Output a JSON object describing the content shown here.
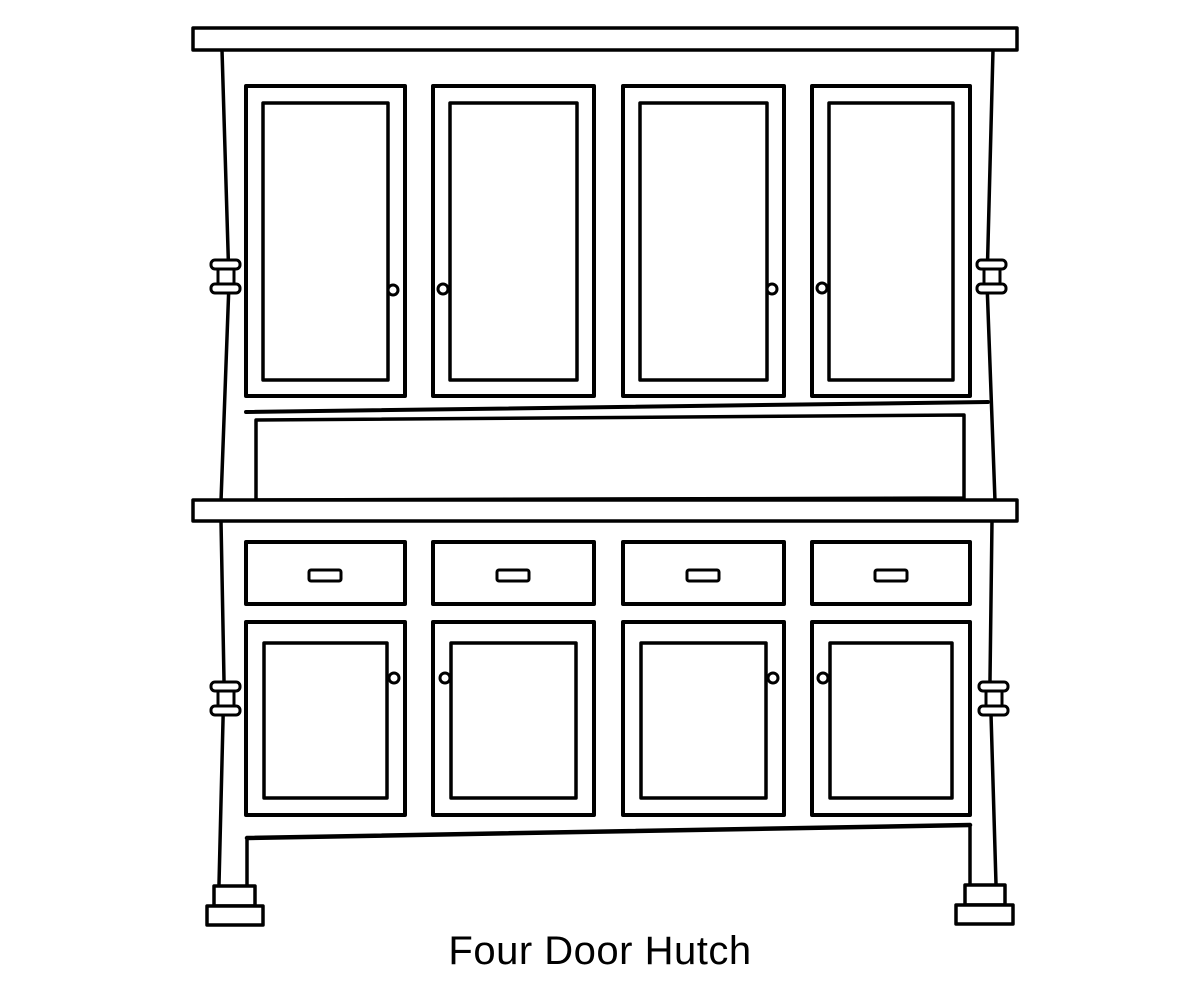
{
  "caption": {
    "text": "Four Door Hutch"
  },
  "colors": {
    "line": "#000000",
    "background": "#ffffff",
    "fill": "#ffffff"
  },
  "figure": {
    "type": "line-drawing",
    "subject": "Four Door Hutch",
    "parts": {
      "upper_doors": 4,
      "upper_door_knobs": 4,
      "open_shelf_bays": 1,
      "drawers": 4,
      "drawer_pulls": 4,
      "lower_doors": 4,
      "lower_door_knobs": 4,
      "side_post_finials": 4,
      "stepped_feet": 2
    }
  }
}
